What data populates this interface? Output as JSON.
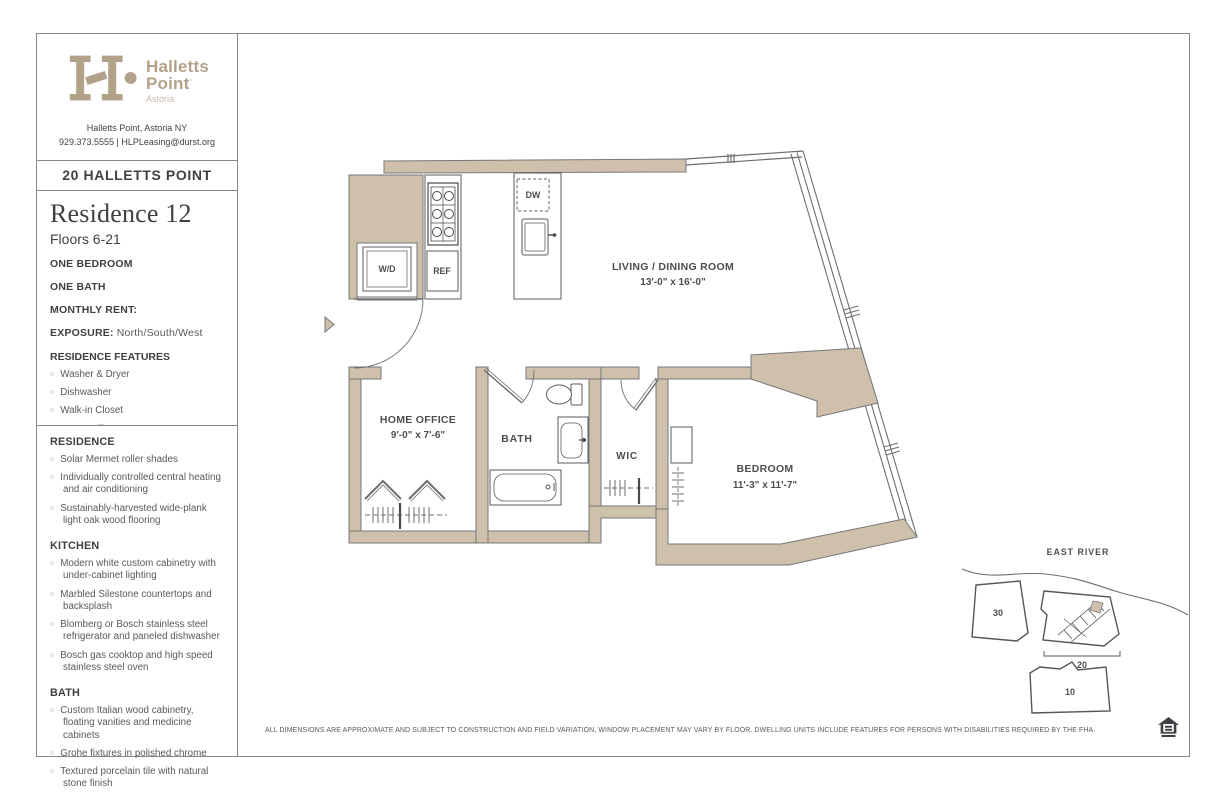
{
  "brand": {
    "name_line1": "Halletts",
    "name_line2": "Point",
    "trademark": "·",
    "tagline": "Astoria",
    "address": "Halletts Point, Astoria NY",
    "contact": "929.373.5555 | HLPLeasing@durst.org"
  },
  "building": {
    "title": "20 HALLETTS POINT"
  },
  "residence": {
    "title": "Residence 12",
    "floors": "Floors 6-21",
    "bedrooms": "ONE BEDROOM",
    "baths": "ONE BATH",
    "rent_label": "MONTHLY RENT:",
    "exposure_label": "EXPOSURE:",
    "exposure_value": " North/South/West",
    "features_title": "RESIDENCE FEATURES",
    "features": [
      "Washer & Dryer",
      "Dishwasher",
      "Walk-in Closet",
      "Home Office",
      "Corner"
    ]
  },
  "amenities": {
    "residence_title": "RESIDENCE",
    "residence_items": [
      "Solar Mermet roller shades",
      "Individually controlled central heating and air conditioning",
      "Sustainably-harvested wide-plank light oak wood flooring"
    ],
    "kitchen_title": "KITCHEN",
    "kitchen_items": [
      "Modern white custom cabinetry with under-cabinet lighting",
      "Marbled Silestone countertops and backsplash",
      "Blomberg or Bosch stainless steel refrigerator and paneled dishwasher",
      "Bosch gas cooktop and high speed stainless steel oven"
    ],
    "bath_title": "BATH",
    "bath_items": [
      "Custom Italian wood cabinetry, floating vanities and medicine cabinets",
      "Grohe fixtures in polished chrome",
      "Textured porcelain tile with natural stone finish"
    ]
  },
  "floorplan": {
    "labels": {
      "living": "LIVING / DINING ROOM",
      "living_dims": "13'-0\" x 16'-0\"",
      "home_office": "HOME OFFICE",
      "home_office_dims": "9'-0\" x 7'-6\"",
      "bath": "BATH",
      "wic": "WIC",
      "bedroom": "BEDROOM",
      "bedroom_dims": "11'-3\" x 11'-7\"",
      "washer_dryer": "W/D",
      "refrigerator": "REF",
      "dishwasher": "DW"
    }
  },
  "sitemap": {
    "river_label": "EAST RIVER",
    "building_30": "30",
    "building_20": "20",
    "building_10": "10"
  },
  "footer": {
    "disclaimer": "ALL DIMENSIONS ARE APPROXIMATE AND SUBJECT TO CONSTRUCTION AND FIELD VARIATION, WINDOW PLACEMENT MAY VARY BY FLOOR. DWELLING UNITS INCLUDE FEATURES FOR PERSONS WITH DISABILITIES REQUIRED BY THE FHA.",
    "eho_icon": "equal-housing-opportunity"
  },
  "colors": {
    "wall_tan": "#cfc0ab",
    "brand_tan": "#b3a28a",
    "text_dark": "#414042",
    "text_gray": "#58595b",
    "line_gray": "#6d6e71"
  }
}
